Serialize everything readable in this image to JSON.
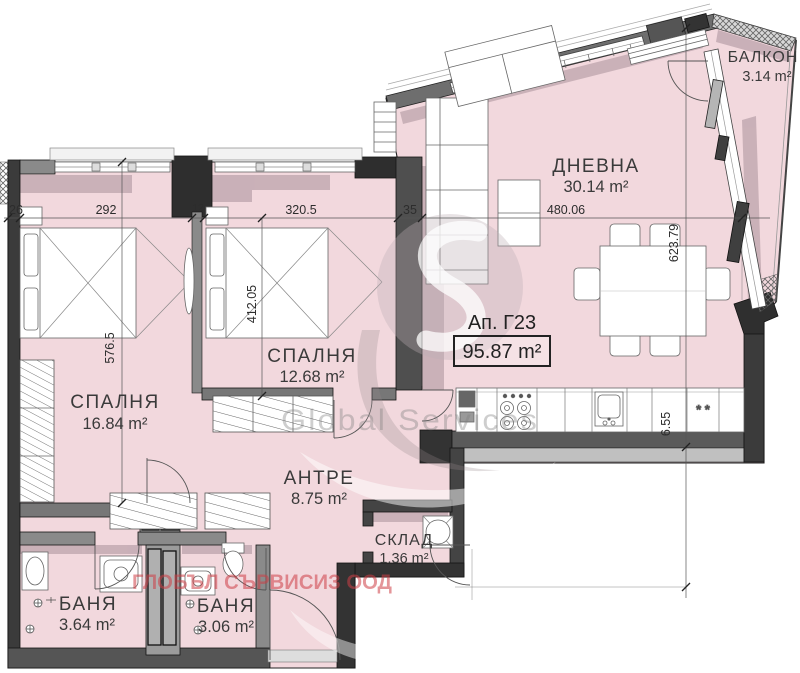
{
  "page": {
    "background": "#ffffff"
  },
  "apartment": {
    "label": "Ап. Г23",
    "area": "95.87 m²"
  },
  "rooms": {
    "living": {
      "name": "ДНЕВНА",
      "area": "30.14 m²"
    },
    "balcony": {
      "name": "БАЛКОН",
      "area": "3.14 m²"
    },
    "bedroom1": {
      "name": "СПАЛНЯ",
      "area": "16.84 m²"
    },
    "bedroom2": {
      "name": "СПАЛНЯ",
      "area": "12.68 m²"
    },
    "hallway": {
      "name": "АНТРЕ",
      "area": "8.75 m²"
    },
    "storage": {
      "name": "СКЛАД",
      "area": "1.36 m²"
    },
    "bathroom1": {
      "name": "БАНЯ",
      "area": "3.64 m²"
    },
    "bathroom2": {
      "name": "БАНЯ",
      "area": "3.06 m²"
    }
  },
  "dimensions": {
    "left_wall_thickness": "26",
    "bedroom1_width": "292",
    "partition": "12",
    "bedroom2_width": "320.5",
    "living_wall_thickness": "35",
    "living_width": "480.06",
    "bedroom1_depth": "576.5",
    "bedroom2_depth": "412.05",
    "living_depth": "623.79",
    "kitchen_segment": "6.55"
  },
  "symbols": {
    "fridge_marks": "* *"
  },
  "watermarks": {
    "company_cyrillic": "ГЛОБЪЛ СЪРВИСИЗ ООД",
    "company_latin": "Global Services"
  },
  "colors": {
    "room_fill": "#f2d8dd",
    "wall_dark": "#3a3a3a",
    "wall_gray": "#8a8a8a",
    "shadow": "#c3aab2",
    "watermark_red": "#cd3e46",
    "line": "#2d2d2d"
  }
}
